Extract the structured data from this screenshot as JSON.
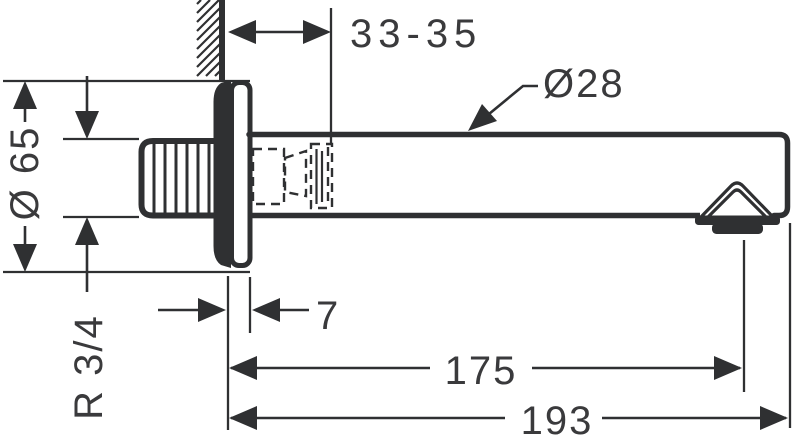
{
  "drawing": {
    "kind": "technical-dimension-drawing",
    "subject": "wall-mounted bath spout, side view",
    "colors": {
      "line": "#2f3032",
      "text": "#3a3a3c",
      "background": "#ffffff"
    },
    "labels": {
      "wall_clearance": "33-35",
      "spout_tube_diameter": "Ø28",
      "escutcheon_diameter": "Ø 65",
      "thread_size": "R 3/4",
      "escutcheon_depth": "7",
      "outlet_projection": "175",
      "total_projection": "193"
    }
  }
}
